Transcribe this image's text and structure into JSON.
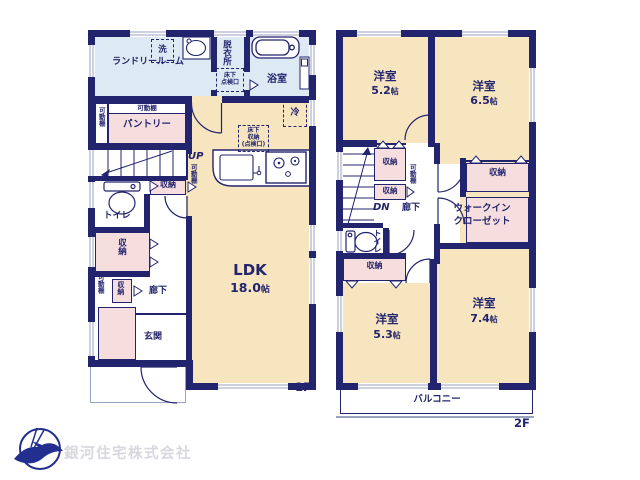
{
  "branding": {
    "company_name": "銀河住宅株式会社",
    "logo_icon": "bird-in-circle-logo"
  },
  "palette": {
    "wall_navy": "#23246e",
    "floor_tan": "#f7e5bf",
    "wet_area_blue": "#dde9f3",
    "closet_pink": "#f7dede",
    "window_gray": "#9aa2c2",
    "company_text_gray": "#d7d7df"
  },
  "floor1": {
    "floor_label": "1F",
    "ldk": {
      "name": "LDK",
      "size": "18.0",
      "unit": "帖"
    },
    "laundry_room": "ランドリールーム",
    "washer": "洗",
    "dressing_room": "脱衣所",
    "underfloor_hatch_line1": "床下",
    "underfloor_hatch_line2": "点検口",
    "bathroom": "浴室",
    "movable_shelf": "可動棚",
    "pantry": "パントリー",
    "stairs_up": "UP",
    "storage": "収納",
    "toilet": "トイレ",
    "refrigerator": "冷",
    "underfloor_storage_line1": "床下",
    "underfloor_storage_line2": "収納",
    "underfloor_storage_line3": "(点検口)",
    "hallway": "廊下",
    "entrance": "玄関"
  },
  "floor2": {
    "floor_label": "2F",
    "room_52": {
      "name": "洋室",
      "size": "5.2",
      "unit": "帖"
    },
    "room_65": {
      "name": "洋室",
      "size": "6.5",
      "unit": "帖"
    },
    "room_53": {
      "name": "洋室",
      "size": "5.3",
      "unit": "帖"
    },
    "room_74": {
      "name": "洋室",
      "size": "7.4",
      "unit": "帖"
    },
    "storage": "収納",
    "movable_shelf": "可動棚",
    "stairs_down": "DN",
    "hallway": "廊下",
    "toilet": "トイレ",
    "walk_in_closet_line1": "ウォークイン",
    "walk_in_closet_line2": "クローゼット",
    "balcony": "バルコニー"
  }
}
